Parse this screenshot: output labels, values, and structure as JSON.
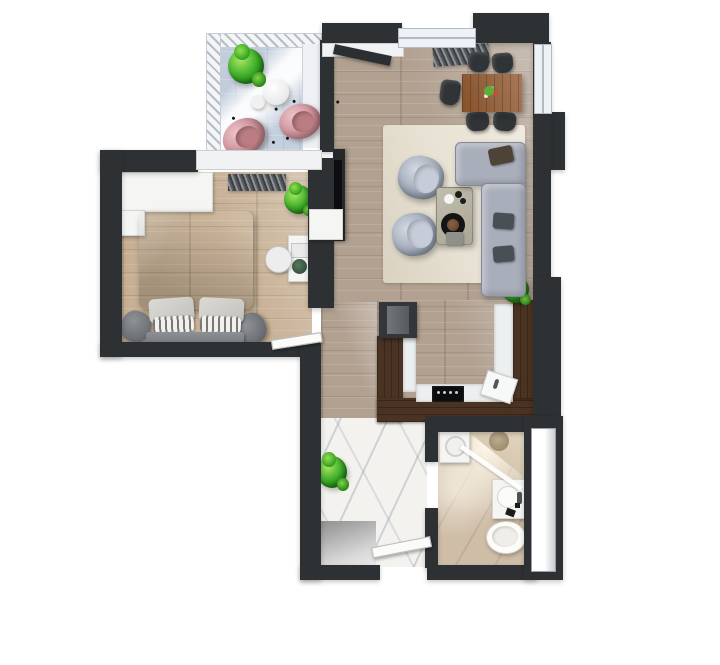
{
  "scene": {
    "title": "3D rendered apartment floor plan, top-down view",
    "canvas": {
      "width": 720,
      "height": 665
    }
  },
  "palette": {
    "wall": "#2e3133",
    "counter_wood": "#4a3322",
    "living_floor": "#b2a191",
    "bedroom_floor": "#c7b094",
    "hall_marble": "#f3f2ef",
    "bath_floor": "#cfbda7",
    "balcony_floor": "#c2cddc",
    "rug": "#e7e1d3",
    "sofa_gray": "#a9aebb",
    "armchair_gray": "#9aa3b2",
    "bed_duvet": "#54585d",
    "pouf_gray": "#6f7276",
    "egg_chair_pink": "#cd9098",
    "plant_green": "#3fae2a",
    "dining_table_wood": "#91582e",
    "dark_furniture": "#303436",
    "white_furniture": "#f5f5f4"
  },
  "rooms": [
    {
      "id": "balcony",
      "furniture": [
        "potted-plant",
        "round-table",
        "stool",
        "egg-chair",
        "egg-chair",
        "railing"
      ]
    },
    {
      "id": "living-room",
      "furniture": [
        "dining-table",
        "dining-chair-x5",
        "striped-doormat",
        "area-rug",
        "armchair",
        "armchair",
        "coffee-table",
        "l-shaped-sofa",
        "tv-unit",
        "potted-plant",
        "balcony-door"
      ]
    },
    {
      "id": "bedroom",
      "furniture": [
        "wardrobe",
        "striped-rug",
        "potted-plant",
        "double-bed",
        "pillows",
        "bench",
        "pouf",
        "pouf",
        "desk",
        "laptop",
        "desk-chair",
        "door"
      ]
    },
    {
      "id": "kitchen",
      "furniture": [
        "fridge",
        "u-shaped-counter",
        "cooktop",
        "sink"
      ]
    },
    {
      "id": "hallway",
      "furniture": [
        "potted-plant",
        "cabinet",
        "floor-mat",
        "open-door",
        "entry-opening"
      ]
    },
    {
      "id": "bathroom",
      "furniture": [
        "washing-machine",
        "corner-shower",
        "vanity-sink",
        "toilet",
        "side-window-shaft"
      ]
    }
  ]
}
